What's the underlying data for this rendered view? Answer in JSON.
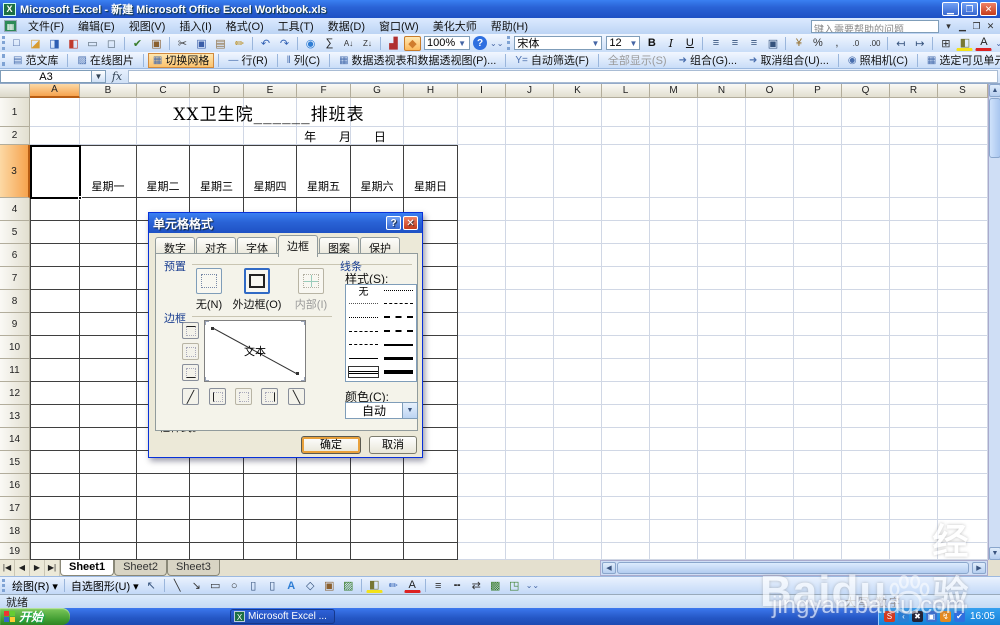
{
  "window": {
    "title": "Microsoft Excel - 新建 Microsoft Office Excel Workbook.xls",
    "help_placeholder": "键入需要帮助的问题"
  },
  "menus": [
    "文件(F)",
    "编辑(E)",
    "视图(V)",
    "插入(I)",
    "格式(O)",
    "工具(T)",
    "数据(D)",
    "窗口(W)",
    "美化大师",
    "帮助(H)"
  ],
  "standard_toolbar": {
    "zoom": "100%",
    "icons": [
      {
        "n": "new-document-icon",
        "g": "□",
        "c": "#3c5a99"
      },
      {
        "n": "open-folder-icon",
        "g": "◪",
        "c": "#d79b2f"
      },
      {
        "n": "save-icon",
        "g": "◨",
        "c": "#2f5fb3"
      },
      {
        "n": "permission-icon",
        "g": "◧",
        "c": "#c0392b"
      },
      {
        "n": "print-icon",
        "g": "▭",
        "c": "#5a6b7a"
      },
      {
        "n": "print-preview-icon",
        "g": "◻",
        "c": "#5a6b7a"
      },
      {
        "sep": true
      },
      {
        "n": "spelling-icon",
        "g": "✔",
        "c": "#3a7d2c"
      },
      {
        "n": "research-icon",
        "g": "▣",
        "c": "#8a5f2e"
      },
      {
        "sep": true
      },
      {
        "n": "cut-icon",
        "g": "✂",
        "c": "#333333"
      },
      {
        "n": "copy-icon",
        "g": "▣",
        "c": "#3b5ea8"
      },
      {
        "n": "paste-icon",
        "g": "▤",
        "c": "#8d6e42"
      },
      {
        "n": "format-painter-icon",
        "g": "✏",
        "c": "#b8860b"
      },
      {
        "sep": true
      },
      {
        "n": "undo-icon",
        "g": "↶",
        "c": "#2f5fb3"
      },
      {
        "n": "redo-icon",
        "g": "↷",
        "c": "#2f5fb3"
      },
      {
        "sep": true
      },
      {
        "n": "hyperlink-icon",
        "g": "◉",
        "c": "#2e7dd4"
      },
      {
        "n": "autosum-icon",
        "g": "∑",
        "c": "#222222"
      },
      {
        "n": "sort-ascending-icon",
        "g": "A↓",
        "c": "#333333"
      },
      {
        "n": "sort-descending-icon",
        "g": "Z↓",
        "c": "#333333"
      },
      {
        "sep": true
      },
      {
        "n": "chart-wizard-icon",
        "g": "▟",
        "c": "#b03030"
      },
      {
        "n": "drawing-icon",
        "g": "◆",
        "c": "#d07c2e",
        "active": true
      }
    ]
  },
  "formatting_toolbar": {
    "font_name": "宋体",
    "font_size": "12",
    "icons": [
      {
        "n": "bold-icon",
        "g": "B",
        "c": "#111111",
        "bold": true
      },
      {
        "n": "italic-icon",
        "g": "I",
        "c": "#111111",
        "italic": true
      },
      {
        "n": "underline-icon",
        "g": "U",
        "c": "#111111",
        "underline": true
      },
      {
        "sep": true
      },
      {
        "n": "align-left-icon",
        "g": "≡",
        "c": "#35527c"
      },
      {
        "n": "align-center-icon",
        "g": "≡",
        "c": "#35527c"
      },
      {
        "n": "align-right-icon",
        "g": "≡",
        "c": "#35527c"
      },
      {
        "n": "merge-center-icon",
        "g": "▣",
        "c": "#35527c"
      },
      {
        "sep": true
      },
      {
        "n": "currency-icon",
        "g": "¥",
        "c": "#946f2c"
      },
      {
        "n": "percent-icon",
        "g": "%",
        "c": "#333333"
      },
      {
        "n": "comma-style-icon",
        "g": ",",
        "c": "#333333"
      },
      {
        "n": "increase-decimal-icon",
        "g": ".0",
        "c": "#333333"
      },
      {
        "n": "decrease-decimal-icon",
        "g": ".00",
        "c": "#333333"
      },
      {
        "sep": true
      },
      {
        "n": "decrease-indent-icon",
        "g": "↤",
        "c": "#35527c"
      },
      {
        "n": "increase-indent-icon",
        "g": "↦",
        "c": "#35527c"
      },
      {
        "sep": true
      },
      {
        "n": "borders-icon",
        "g": "⊞",
        "c": "#333333"
      },
      {
        "n": "fill-color-icon",
        "g": "◧",
        "c": "#777733",
        "uy": true
      },
      {
        "n": "font-color-icon",
        "g": "A",
        "c": "#222222",
        "ur": true
      }
    ]
  },
  "addin_toolbar": {
    "items": [
      {
        "label": "范文库",
        "icon": "▤"
      },
      {
        "label": "在线图片",
        "icon": "▨"
      },
      {
        "label": "切换网格",
        "icon": "▦",
        "active": true
      },
      {
        "label": "行(R)",
        "icon": "―"
      },
      {
        "label": "列(C)",
        "icon": "‖"
      },
      {
        "label": "数据透视表和数据透视图(P)...",
        "icon": "▦"
      },
      {
        "label": "自动筛选(F)",
        "icon": "Y="
      },
      {
        "label": "全部显示(S)",
        "icon": "",
        "disabled": true
      },
      {
        "label": "组合(G)...",
        "icon": "➜"
      },
      {
        "label": "取消组合(U)...",
        "icon": "➜"
      },
      {
        "label": "照相机(C)",
        "icon": "◉"
      },
      {
        "label": "选定可见单元格(S)",
        "icon": "▦"
      },
      {
        "label": "朗读单元格(E)",
        "icon": "◗",
        "disabled": true
      },
      {
        "label": "按回车键开始朗读(K)",
        "icon": "◗",
        "disabled": true
      }
    ]
  },
  "formula_bar": {
    "name_box": "A3",
    "fx": "fx",
    "formula": ""
  },
  "sheet": {
    "columns": [
      "A",
      "B",
      "C",
      "D",
      "E",
      "F",
      "G",
      "H",
      "I",
      "J",
      "K",
      "L",
      "M",
      "N",
      "O",
      "P",
      "Q",
      "R",
      "S"
    ],
    "rows": [
      "1",
      "2",
      "3",
      "4",
      "5",
      "6",
      "7",
      "8",
      "9",
      "10",
      "11",
      "12",
      "13",
      "14",
      "15",
      "16",
      "17",
      "18",
      "19"
    ],
    "selected_cell": "A3",
    "title": "XX卫生院______排班表",
    "date_line": "年      月      日",
    "weekdays": [
      "星期一",
      "星期二",
      "星期三",
      "星期四",
      "星期五",
      "星期六",
      "星期日"
    ]
  },
  "dialog": {
    "title": "单元格格式",
    "tabs": [
      "数字",
      "对齐",
      "字体",
      "边框",
      "图案",
      "保护"
    ],
    "active_tab": "边框",
    "presets": {
      "label": "预置",
      "none": "无(N)",
      "outline": "外边框(O)",
      "inside": "内部(I)"
    },
    "border": {
      "label": "边框",
      "preview_text": "文本"
    },
    "line": {
      "label": "线条",
      "style_label": "样式(S):",
      "none_item": "无",
      "left_styles": [
        "none",
        "hair",
        "dot",
        "dashdot",
        "dash",
        "thin",
        "double"
      ],
      "right_styles": [
        "dashdotdot",
        "dashshort",
        "dashdot2",
        "mdash",
        "msolid",
        "thick",
        "xthick"
      ],
      "selected_style": "double",
      "color_label": "颜色(C):",
      "color_value": "自动"
    },
    "hint": "单击预置选项、预览草图及上面的按钮可以添加边框样式。",
    "ok": "确定",
    "cancel": "取消"
  },
  "tabs_bar": {
    "sheets": [
      "Sheet1",
      "Sheet2",
      "Sheet3"
    ],
    "active": "Sheet1"
  },
  "drawing_toolbar": {
    "draw_label": "绘图(R)",
    "autoshapes_label": "自选图形(U)",
    "icons": [
      {
        "n": "select-objects-icon",
        "g": "↖",
        "c": "#35527c"
      },
      {
        "sep": true
      },
      {
        "n": "line-icon",
        "g": "╲",
        "c": "#333333"
      },
      {
        "n": "arrow-icon",
        "g": "↘",
        "c": "#333333"
      },
      {
        "n": "rectangle-icon",
        "g": "▭",
        "c": "#333333"
      },
      {
        "n": "oval-icon",
        "g": "○",
        "c": "#333333"
      },
      {
        "n": "text-box-icon",
        "g": "▯",
        "c": "#35527c"
      },
      {
        "n": "vertical-text-box-icon",
        "g": "▯",
        "c": "#35527c"
      },
      {
        "n": "wordart-icon",
        "g": "A",
        "c": "#2e7dd4",
        "bold": true
      },
      {
        "n": "diagram-icon",
        "g": "◇",
        "c": "#35527c"
      },
      {
        "n": "clip-art-icon",
        "g": "▣",
        "c": "#8a5f2e"
      },
      {
        "n": "insert-picture-icon",
        "g": "▨",
        "c": "#3a7d2c"
      },
      {
        "sep": true
      },
      {
        "n": "fill-color-icon",
        "g": "◧",
        "c": "#777733",
        "uy": true
      },
      {
        "n": "line-color-icon",
        "g": "✏",
        "c": "#2f5fb3"
      },
      {
        "n": "font-color-icon",
        "g": "A",
        "c": "#222222",
        "ur": true
      },
      {
        "sep": true
      },
      {
        "n": "line-style-icon",
        "g": "≡",
        "c": "#333333"
      },
      {
        "n": "dash-style-icon",
        "g": "╍",
        "c": "#333333"
      },
      {
        "n": "arrow-style-icon",
        "g": "⇄",
        "c": "#333333"
      },
      {
        "n": "shadow-style-icon",
        "g": "▩",
        "c": "#3a7d2c"
      },
      {
        "n": "threed-style-icon",
        "g": "◳",
        "c": "#3a7d2c"
      }
    ]
  },
  "status_bar": {
    "ready": "就绪",
    "caps": "大写",
    "num": "数字"
  },
  "taskbar": {
    "start": "开始",
    "task": "Microsoft Excel ...",
    "time": "16:05",
    "tray_icons": [
      {
        "n": "tray-sogou-icon",
        "g": "S",
        "bg": "#d43a1e"
      },
      {
        "n": "tray-chevron-icon",
        "g": "‹",
        "bg": "#2a7fd4"
      },
      {
        "n": "tray-x-icon",
        "g": "✖",
        "bg": "#222233"
      },
      {
        "n": "tray-network-icon",
        "g": "▣",
        "bg": "#3a6fd0"
      },
      {
        "n": "tray-swoosh-icon",
        "g": "↯",
        "bg": "#e58a1f"
      },
      {
        "n": "tray-shield-icon",
        "g": "✔",
        "bg": "#2f6fe0"
      }
    ]
  },
  "watermark": {
    "brand": "Baidu",
    "brand_suffix": "经验",
    "url": "jingyan.baidu.com"
  }
}
